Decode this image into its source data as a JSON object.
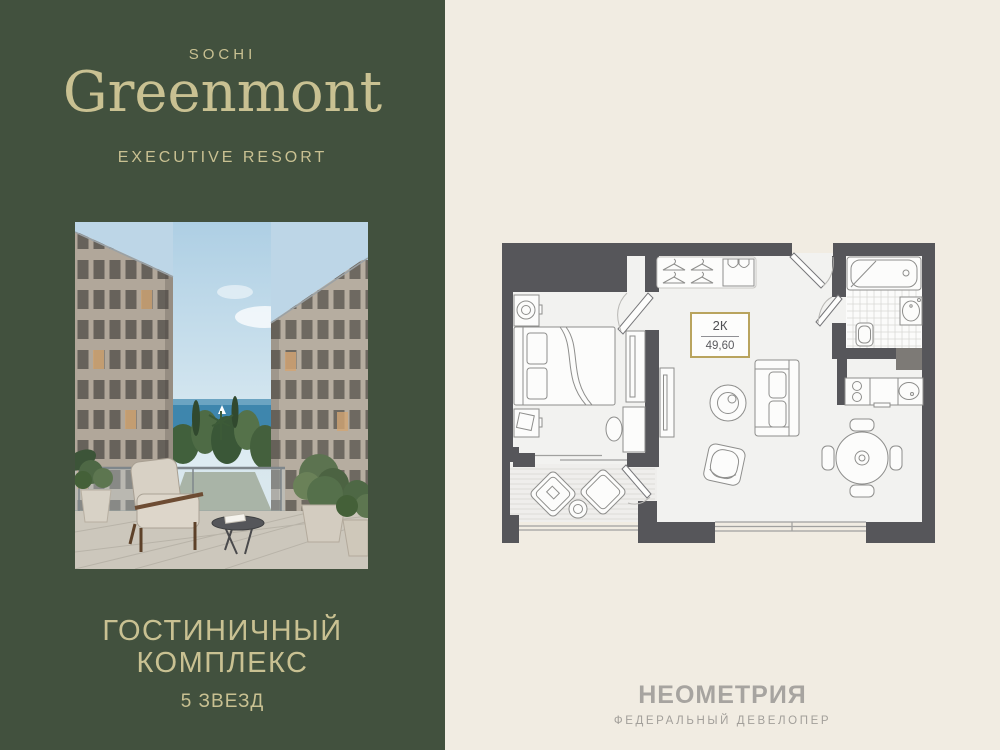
{
  "brand_panel": {
    "background_color": "#42513e",
    "accent_color": "#c9c192",
    "city": "SOCHI",
    "name": "Greenmont",
    "tagline": "EXECUTIVE RESORT",
    "heading_line1": "ГОСТИНИЧНЫЙ",
    "heading_line2": "КОМПЛЕКС",
    "stars": "5 ЗВЕЗД",
    "photo": "courtyard-render-sea-view"
  },
  "plan_panel": {
    "background_color": "#f1ece2",
    "wall_color": "#56565a",
    "badge": {
      "rooms": "2К",
      "area": "49,60",
      "border_color": "#b9a45e"
    },
    "developer_name": "НЕОМЕТРИЯ",
    "developer_tagline": "ФЕДЕРАЛЬНЫЙ ДЕВЕЛОПЕР",
    "developer_color": "#a7a4a0"
  }
}
